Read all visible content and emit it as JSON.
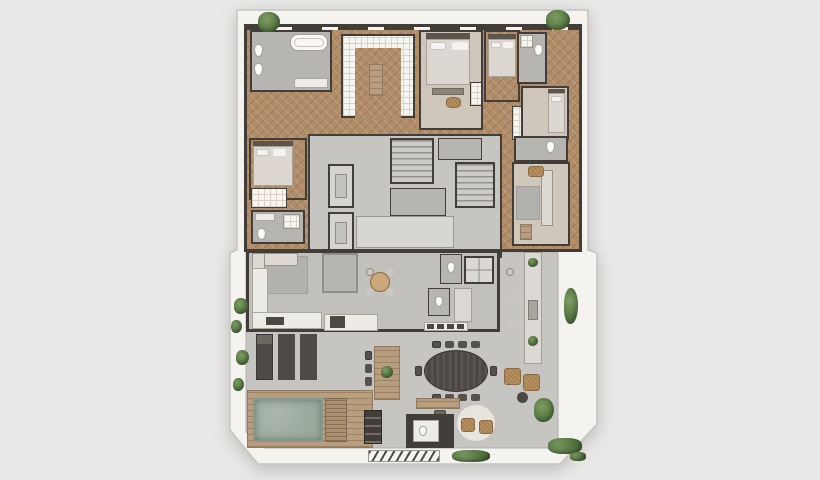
{
  "meta": {
    "scene": "residential-apartment-floor-plan",
    "view": "top-down-render",
    "visible_text": "none"
  },
  "palette": {
    "background": "#e9e8e6",
    "platform": "#f4f3f0",
    "outline": "#c6c4c1",
    "wall": "#423d38",
    "wood_floor": "#b08c68",
    "wood_deck": "#b89e7f",
    "gray_floor": "#b7b5b2",
    "terrace_floor": "#c7c5c2",
    "core_floor": "#c7c5c2",
    "tile_white": "#f7f5f0",
    "tile_grid": "#d8d1c5",
    "carpet": "#cfc7bb",
    "pool_water": "#9dab9f",
    "marble": "#edebe5",
    "furniture_dark": "#4c4944",
    "furniture_light": "#dedad3",
    "wicker": "#b9905f",
    "plant": "#5f7d4c",
    "rug": "#b3b1ad",
    "bed_linen": "#dcd8d1"
  },
  "rooms": {
    "master_bathroom": "master bathroom with bathtub",
    "walk_in_closet": "walk-in closet with island",
    "bedroom_1": "bedroom with double bed",
    "bedroom_2": "bedroom with single bed",
    "bedroom_3": "bedroom with bed on right wall",
    "bedroom_4": "bedroom with closet and ensuite",
    "bathroom_2": "bathroom",
    "bathroom_3": "bathroom",
    "bathroom_4": "bathroom",
    "elevator": "elevator shaft",
    "staircase": "staircase",
    "lobby": "elevator lobby",
    "living_room": "sitting room with sofa",
    "family_room": "family room with sectional sofa and daybed",
    "kitchen": "kitchen with L-counter and island",
    "breakfast_table": "round table with four chairs",
    "skylight": "skylight over lower floor",
    "wc": "powder room",
    "pantry": "pantry counter",
    "dining": "oval dining table with ten chairs",
    "wood_table": "wooden terrace table with chairs and plant",
    "bar": "terrace bar counter with stools",
    "lounge_corner": "wicker armchairs with side table",
    "round_rug": "round rug with two wicker chairs",
    "outdoor_wc": "outdoor wc with marble interior",
    "desk": "wooden console desk",
    "pool": "swimming pool",
    "pool_deck": "timber pool deck with steps",
    "grill": "barbecue grill station",
    "loungers": "three sun loungers",
    "terrace": "wrap-around terrace parapet",
    "vent_grate": "hatched floor grate",
    "planting": "terrace plants and hedges"
  }
}
